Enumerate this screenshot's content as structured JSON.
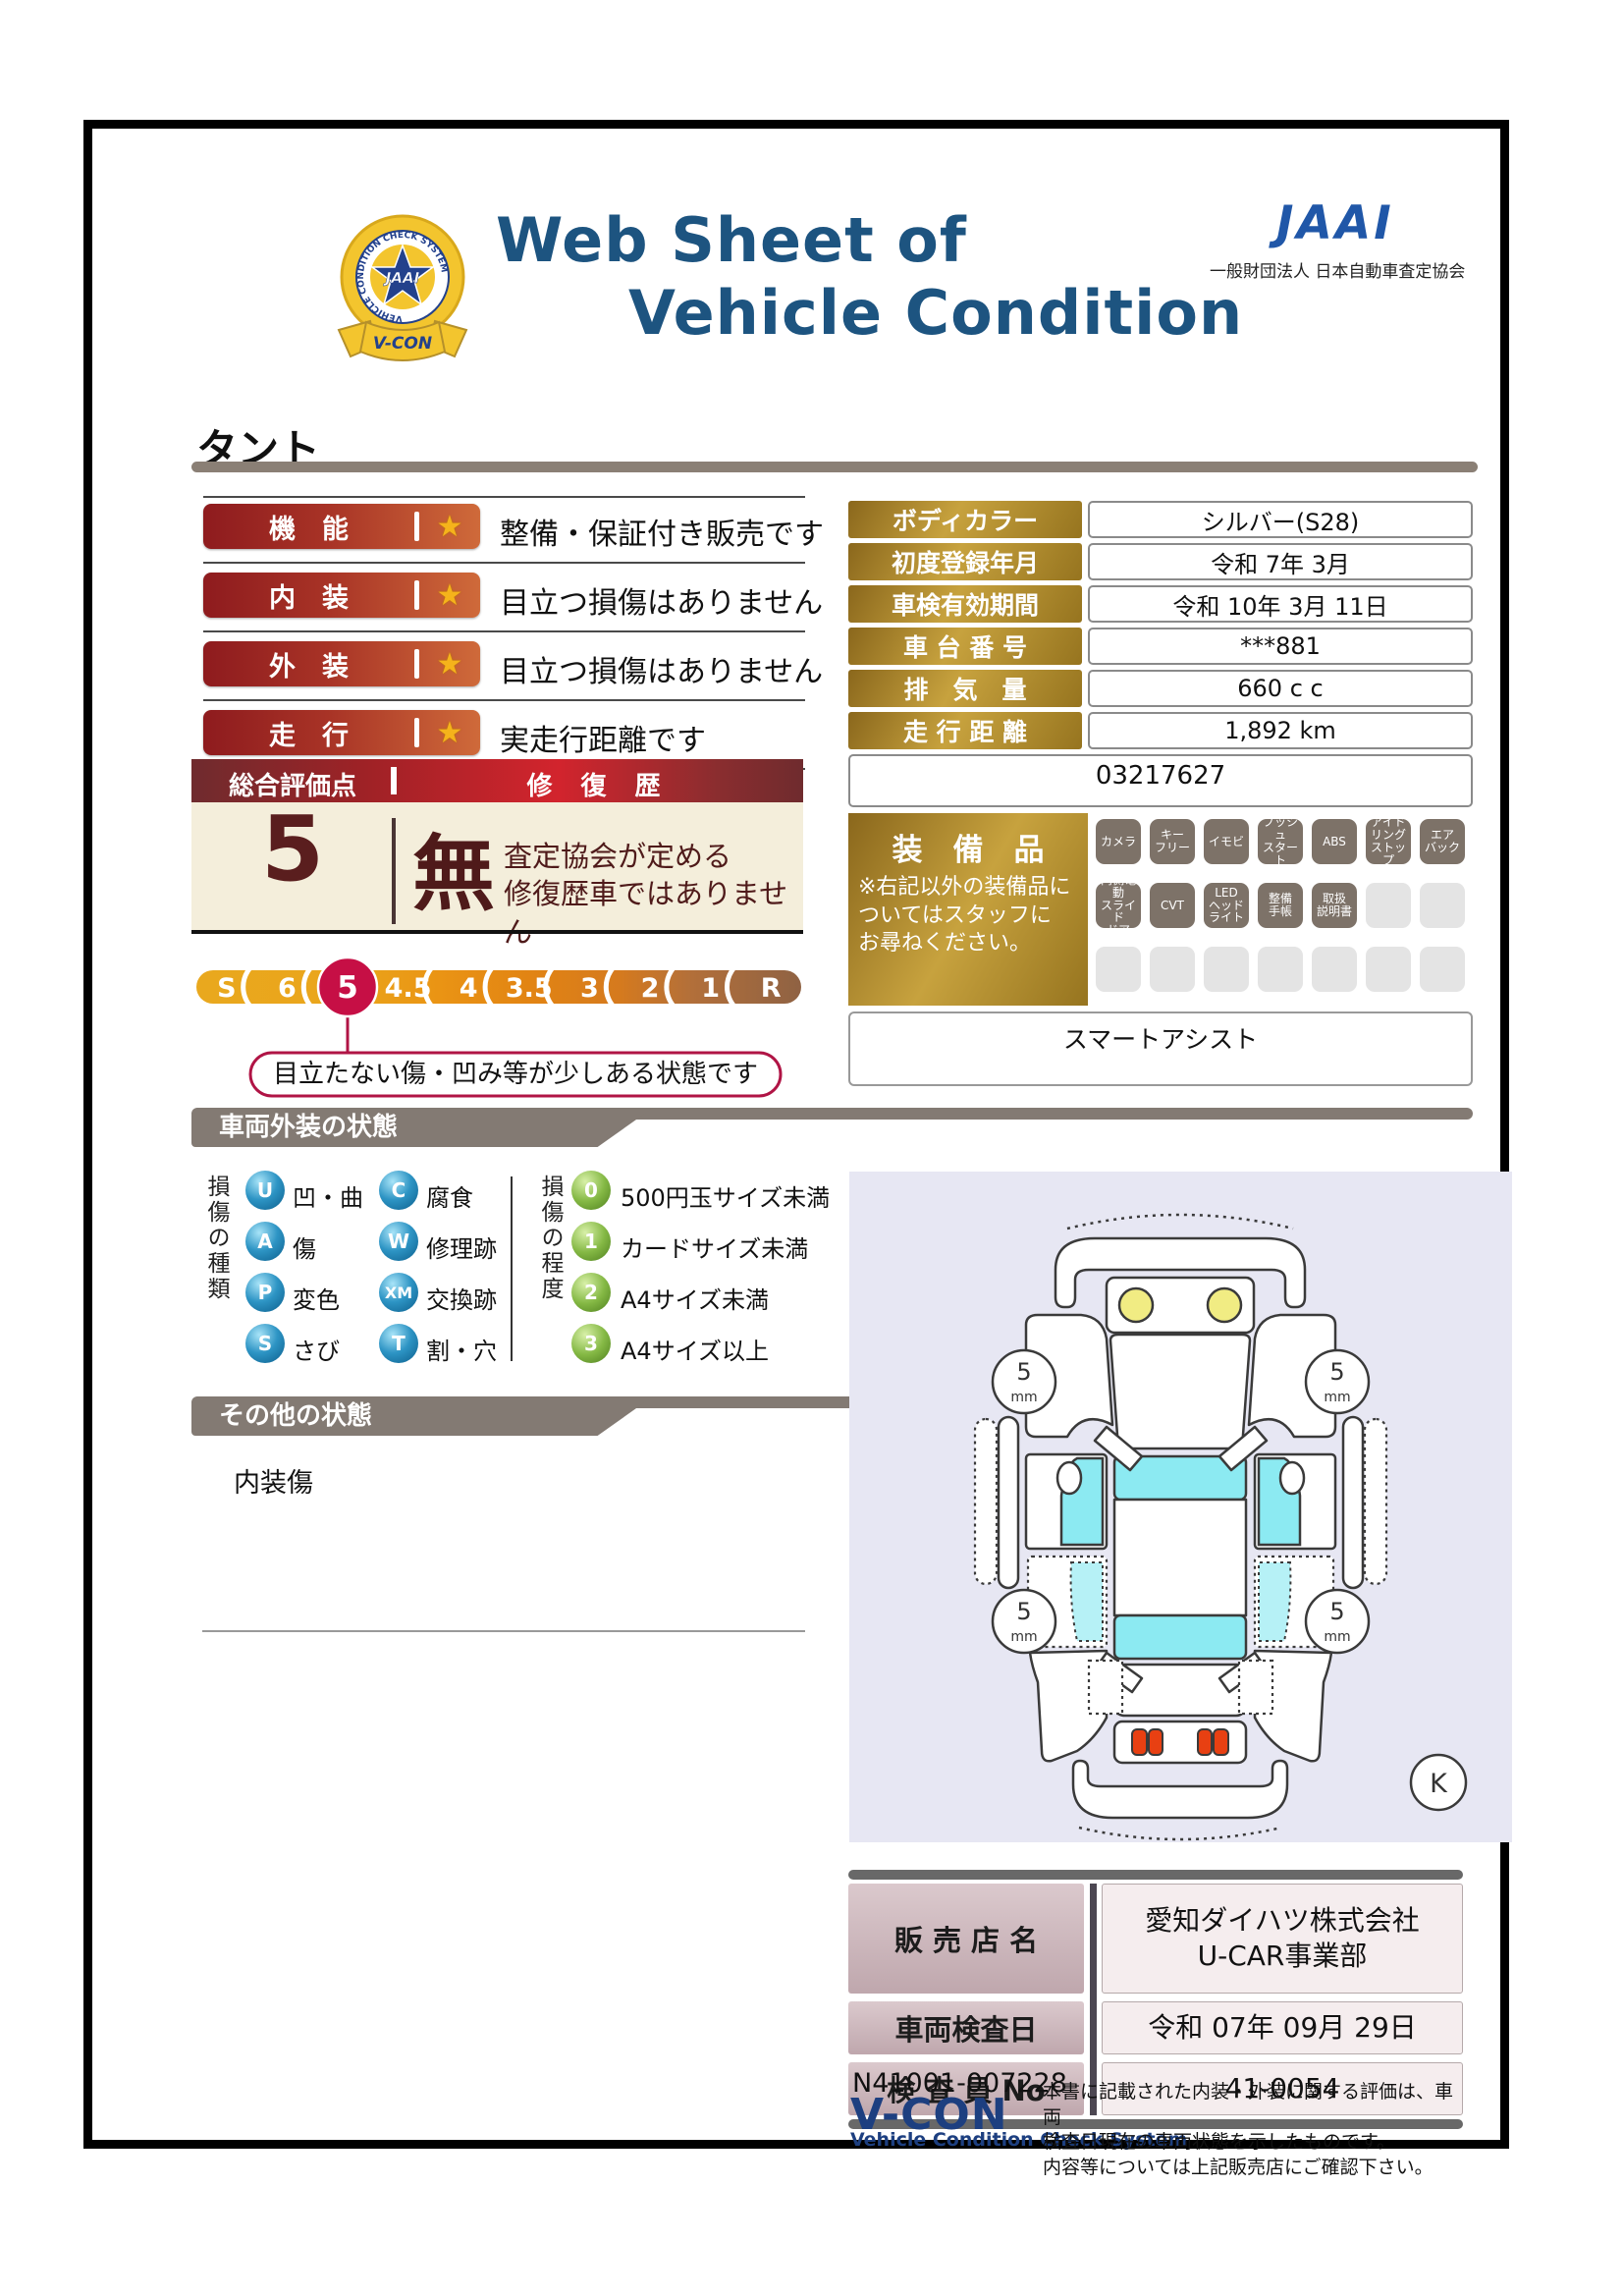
{
  "header": {
    "title_line1": "Web Sheet of",
    "title_line2": "Vehicle Condition",
    "jaai_logo": "JAAI",
    "jaai_subtitle": "一般財団法人 日本自動車査定協会",
    "badge": {
      "vcon": "V-CON",
      "ring_text": "VEHICLE CONDITION CHECK SYSTEM",
      "center": "JAAI"
    }
  },
  "vehicle_name": "タント",
  "ratings": [
    {
      "label": "機　能",
      "star": "★",
      "comment": "整備・保証付き販売です"
    },
    {
      "label": "内　装",
      "star": "★",
      "comment": "目立つ損傷はありません"
    },
    {
      "label": "外　装",
      "star": "★",
      "comment": "目立つ損傷はありません"
    },
    {
      "label": "走　行",
      "star": "★",
      "comment": "実走行距離です"
    }
  ],
  "vehicle_info": {
    "rows": [
      {
        "label": "ボディカラー",
        "value": "シルバー(S28)"
      },
      {
        "label": "初度登録年月",
        "value": "令和 7年 3月"
      },
      {
        "label": "車検有効期間",
        "value": "令和 10年 3月 11日"
      },
      {
        "label": "車 台 番 号",
        "value": "***881"
      },
      {
        "label": "排　気　量",
        "value": "660 c c"
      },
      {
        "label": "走 行 距 離",
        "value": "1,892 km"
      }
    ],
    "reference_number": "03217627"
  },
  "overall": {
    "score_label": "総合評価点",
    "score": "5",
    "repair_label": "修 復 歴",
    "repair_value": "無",
    "repair_note": "査定協会が定める\n修復歴車ではありません",
    "scale": [
      "S",
      "6",
      "5",
      "4.5",
      "4",
      "3.5",
      "3",
      "2",
      "1",
      "R"
    ],
    "selected": "5",
    "callout": "目立たない傷・凹み等が少しある状態です"
  },
  "equipment": {
    "label": "装　備　品",
    "note": "※右記以外の装備品に\nついてはスタッフに\nお尋ねください。",
    "row1": [
      "カメラ",
      "キー\nフリー",
      "イモビ",
      "プッシュ\nスタート",
      "ABS",
      "アイド\nリング\nストップ",
      "エア\nバック"
    ],
    "row2": [
      "両側電動\nスライド\nドア",
      "CVT",
      "LED\nヘッド\nライト",
      "整備\n手帳",
      "取扱\n説明書"
    ],
    "extra": "スマートアシスト"
  },
  "exterior_section": {
    "title": "車両外装の状態",
    "damage_types_label": "損傷の種類",
    "damage_types": [
      {
        "code": "U",
        "label": "凹・曲"
      },
      {
        "code": "C",
        "label": "腐食"
      },
      {
        "code": "A",
        "label": "傷"
      },
      {
        "code": "W",
        "label": "修理跡"
      },
      {
        "code": "P",
        "label": "変色"
      },
      {
        "code": "XM",
        "label": "交換跡"
      },
      {
        "code": "S",
        "label": "さび"
      },
      {
        "code": "T",
        "label": "割・穴"
      }
    ],
    "damage_levels_label": "損傷の程度",
    "damage_levels": [
      {
        "code": "0",
        "label": "500円玉サイズ未満"
      },
      {
        "code": "1",
        "label": "カードサイズ未満"
      },
      {
        "code": "2",
        "label": "A4サイズ未満"
      },
      {
        "code": "3",
        "label": "A4サイズ以上"
      }
    ]
  },
  "other_section": {
    "title": "その他の状態",
    "note": "内装傷"
  },
  "diagram": {
    "tire_depths": [
      "5",
      "5",
      "5",
      "5"
    ],
    "tire_unit": "mm",
    "marker": "K"
  },
  "dealer": {
    "rows": [
      {
        "label": "販 売 店 名",
        "value": "愛知ダイハツ株式会社\nU-CAR事業部"
      },
      {
        "label": "車両検査日",
        "value": "令和 07年 09月 29日"
      },
      {
        "label": "検 査 員 No",
        "value": "41-0054"
      }
    ]
  },
  "footer": {
    "doc_number": "N41001-007228",
    "vcon": "V-CON",
    "vcon_sub": "Vehicle Condition Check System",
    "disclaimer": "本書に記載された内装・外装に関する評価は、車両\n検査日現在の車両状態を示したものです。\n内容等については上記販売店にご確認下さい。"
  },
  "colors": {
    "title_navy": "#1d5480",
    "jaai_blue": "#2057a8",
    "accent_red": "#c60f45",
    "gold": "#c7a23e",
    "section_gray": "#837a73",
    "cream": "#f4eedb",
    "diagram_bg": "#e7e7f3"
  }
}
